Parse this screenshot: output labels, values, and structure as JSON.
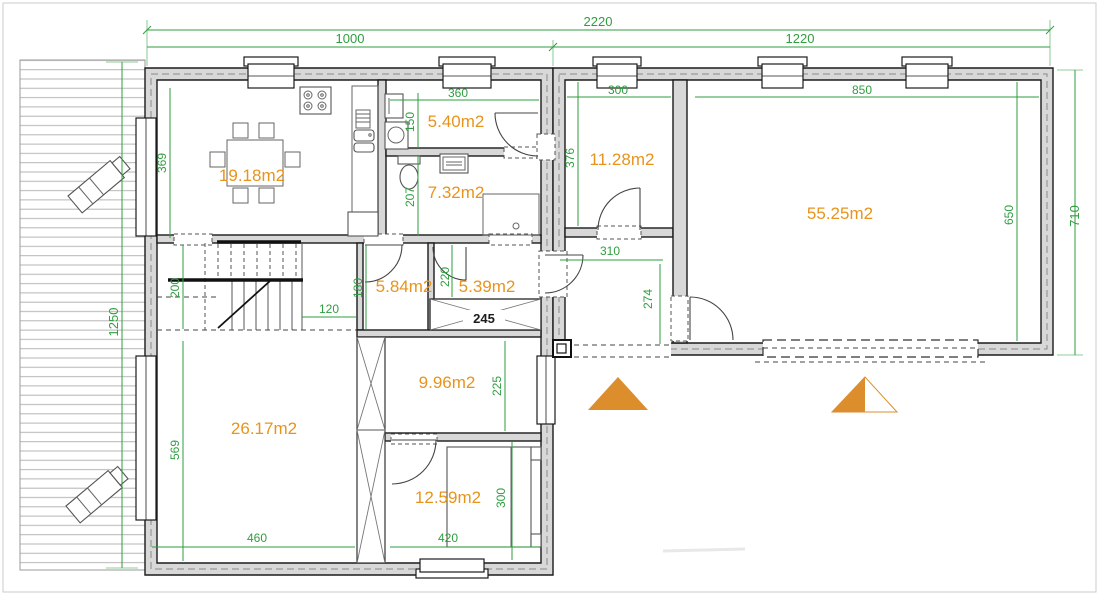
{
  "colors": {
    "dimension_text": "#2f9e3f",
    "area_text": "#e8941c",
    "wall_fill": "#d8d8d8",
    "wall_outline": "#1b1b1b",
    "entrance_triangle": "#dd8e2c"
  },
  "area_labels": {
    "living_dining": "19.18m2",
    "utility_room": "5.40m2",
    "bathroom": "7.32m2",
    "upper_room": "11.28m2",
    "garage": "55.25m2",
    "wc": "5.84m2",
    "closet_room": "5.39m2",
    "middle_room": "9.96m2",
    "lower_room": "26.17m2",
    "bedroom": "12.59m2"
  },
  "dimensions": {
    "total_width": "2220",
    "left_wing_width": "1000",
    "right_wing_width": "1220",
    "right_wing_depth": "710",
    "terrace_length": "1250",
    "living_depth": "369",
    "utility_width": "360",
    "utility_depth": "150",
    "bathroom_depth": "207",
    "upper_room_depth": "376",
    "upper_room_width": "300",
    "garage_width": "850",
    "garage_depth": "650",
    "corridor_depth": "200",
    "stair_clearance": "120",
    "wc_depth": "180",
    "closet_depth": "220",
    "closet_width": "245",
    "hall_width": "310",
    "hall_depth": "274",
    "middle_room_depth": "225",
    "lower_room_depth": "569",
    "lower_room_width": "460",
    "bedroom_width": "420",
    "bedroom_depth": "300"
  }
}
